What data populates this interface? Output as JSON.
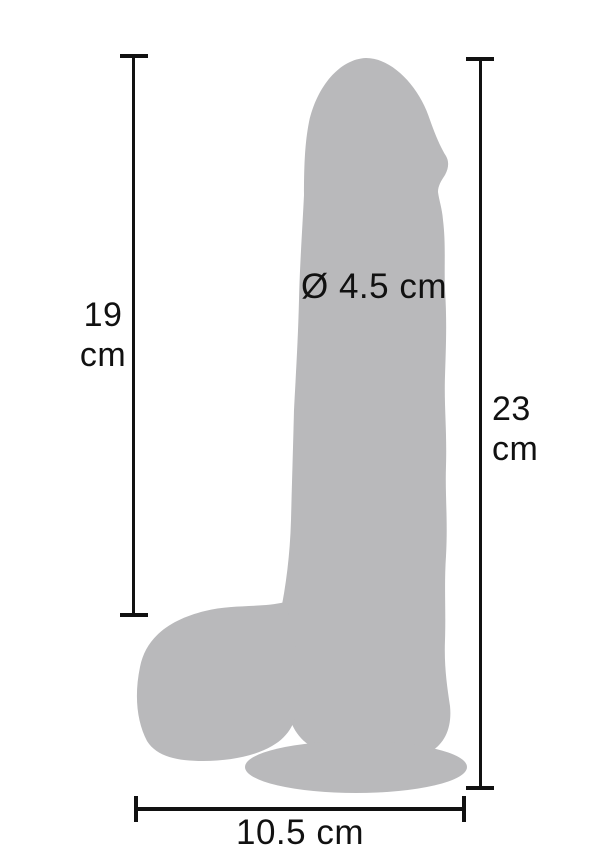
{
  "colors": {
    "background": "#ffffff",
    "silhouette": "#b9b9bb",
    "line": "#111111",
    "text": "#111111"
  },
  "diagram": {
    "left_dimension": {
      "value": "19",
      "unit": "cm"
    },
    "right_dimension": {
      "value": "23",
      "unit": "cm"
    },
    "diameter_label": "Ø 4.5 cm",
    "bottom_dimension_label": "10.5 cm"
  }
}
